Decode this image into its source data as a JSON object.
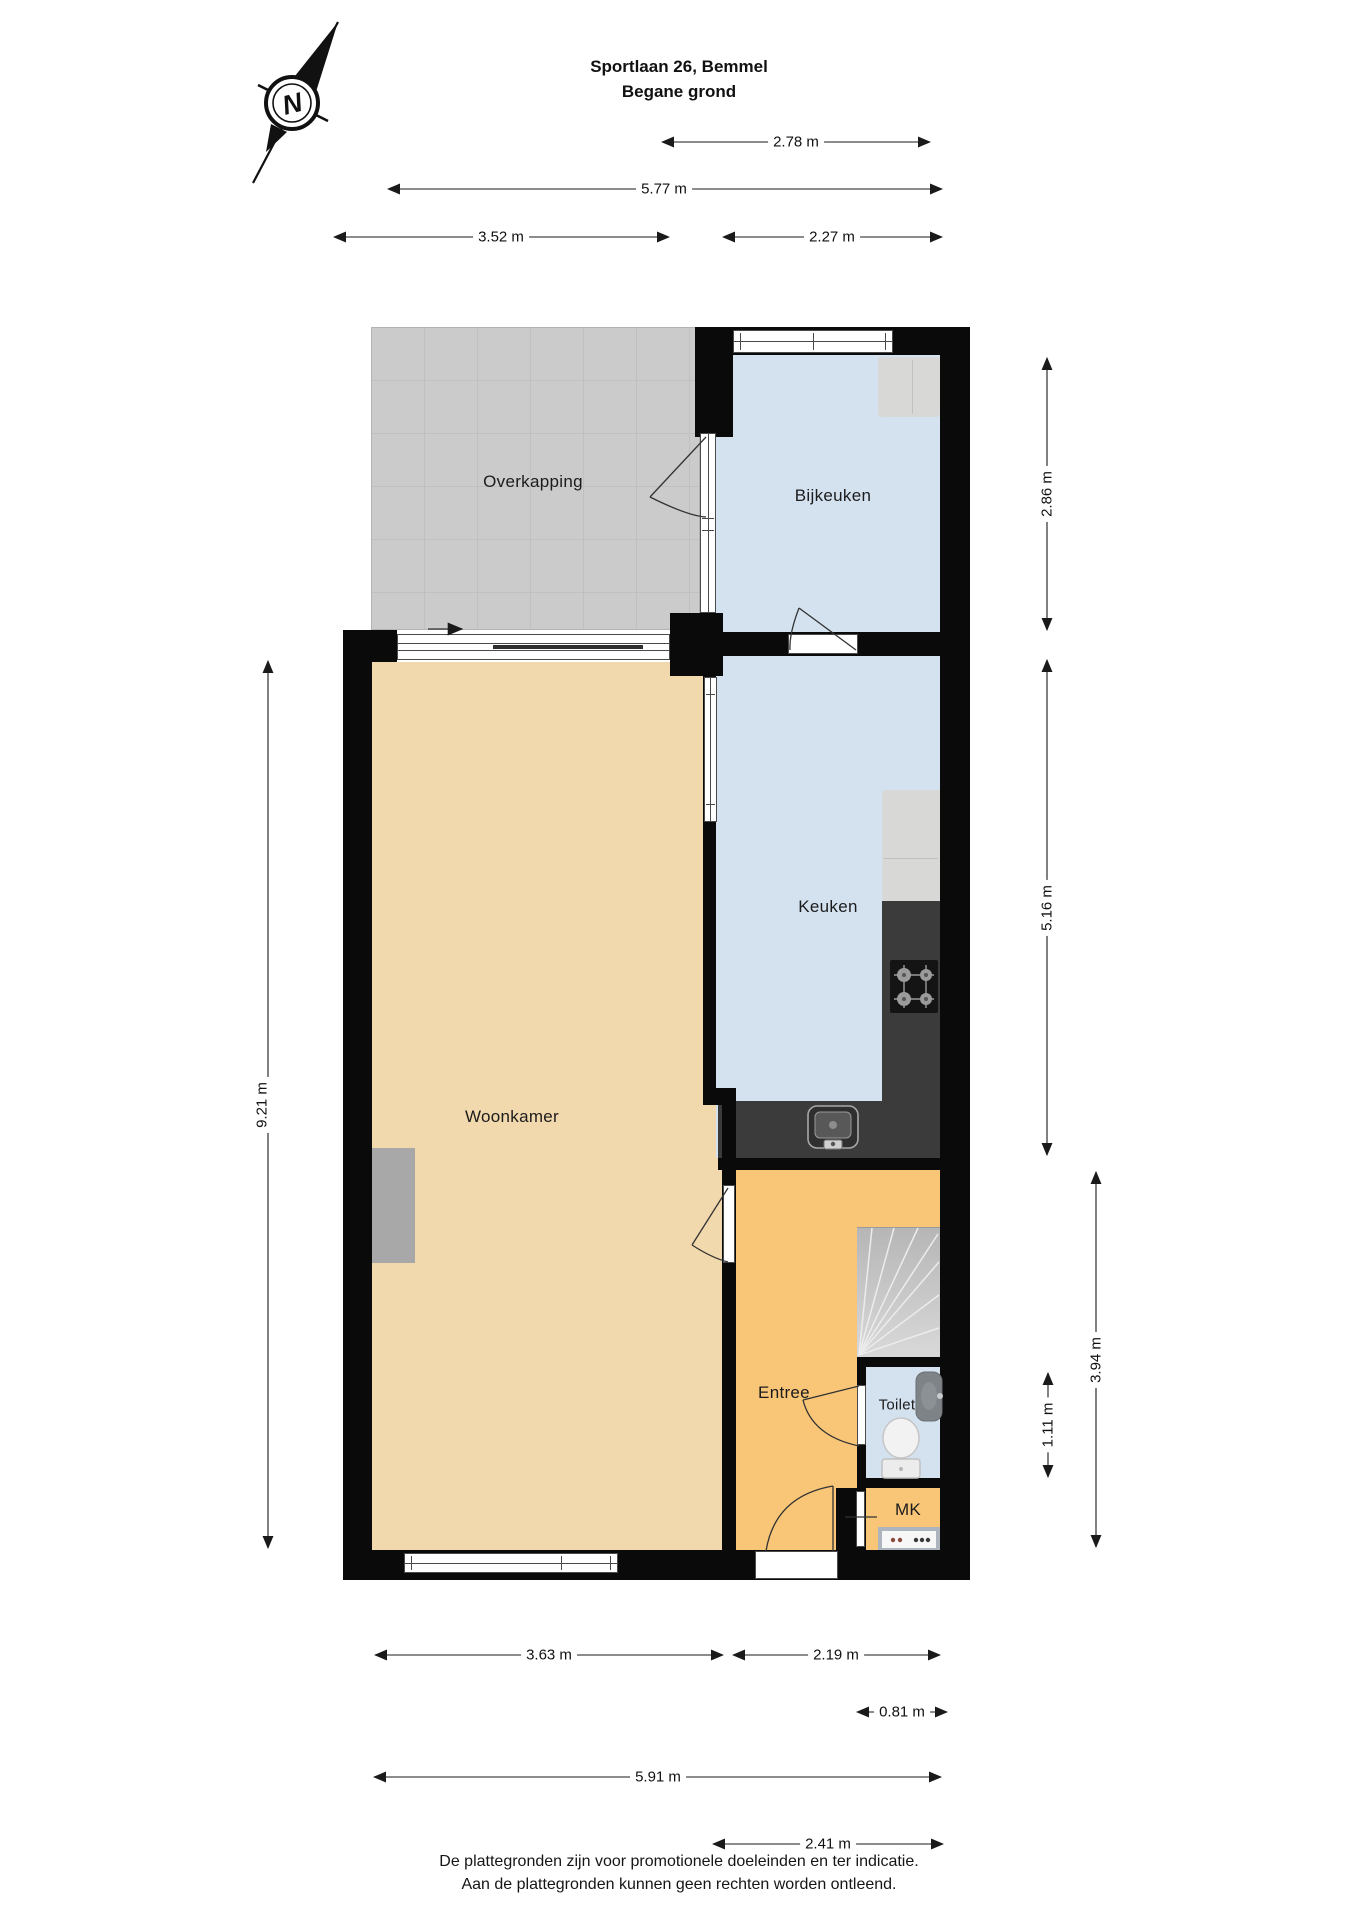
{
  "title": {
    "line1": "Sportlaan 26, Bemmel",
    "line2": "Begane grond"
  },
  "compass": {
    "label": "N"
  },
  "rooms": {
    "overkapping": {
      "label": "Overkapping"
    },
    "bijkeuken": {
      "label": "Bijkeuken"
    },
    "keuken": {
      "label": "Keuken"
    },
    "woonkamer": {
      "label": "Woonkamer"
    },
    "entree": {
      "label": "Entree"
    },
    "toilet": {
      "label": "Toilet"
    },
    "mk": {
      "label": "MK"
    }
  },
  "dimensions": {
    "top_bijkeuken_width": {
      "label": "2.78 m"
    },
    "top_total_width": {
      "label": "5.77 m"
    },
    "top_overkapping_width": {
      "label": "3.52 m"
    },
    "top_bijkeuken_inner": {
      "label": "2.27 m"
    },
    "right_bijkeuken_h": {
      "label": "2.86 m"
    },
    "right_keuken_h": {
      "label": "5.16 m"
    },
    "right_hall_h": {
      "label": "3.94 m"
    },
    "right_toilet_h": {
      "label": "1.11 m"
    },
    "left_total_h": {
      "label": "9.21 m"
    },
    "bottom_woonkamer_w": {
      "label": "3.63 m"
    },
    "bottom_entree_w": {
      "label": "2.19 m"
    },
    "bottom_mk_w": {
      "label": "0.81 m"
    },
    "bottom_total_w": {
      "label": "5.91 m"
    },
    "bottom_right_w": {
      "label": "2.41 m"
    }
  },
  "footer": {
    "line1": "De plattegronden zijn voor promotionele doeleinden en ter indicatie.",
    "line2": "Aan de plattegronden kunnen geen rechten worden ontleend."
  },
  "colors": {
    "wall": "#0a0a0a",
    "room_living": "#f2d9ad",
    "room_wet": "#d4e2f0",
    "room_hall": "#f9c678",
    "canopy": "#cbcbcb",
    "counter": "#3b3b3b",
    "appliance": "#d8d8d6",
    "stairs": "#c9c9c9",
    "niche": "#a8a8a8"
  }
}
